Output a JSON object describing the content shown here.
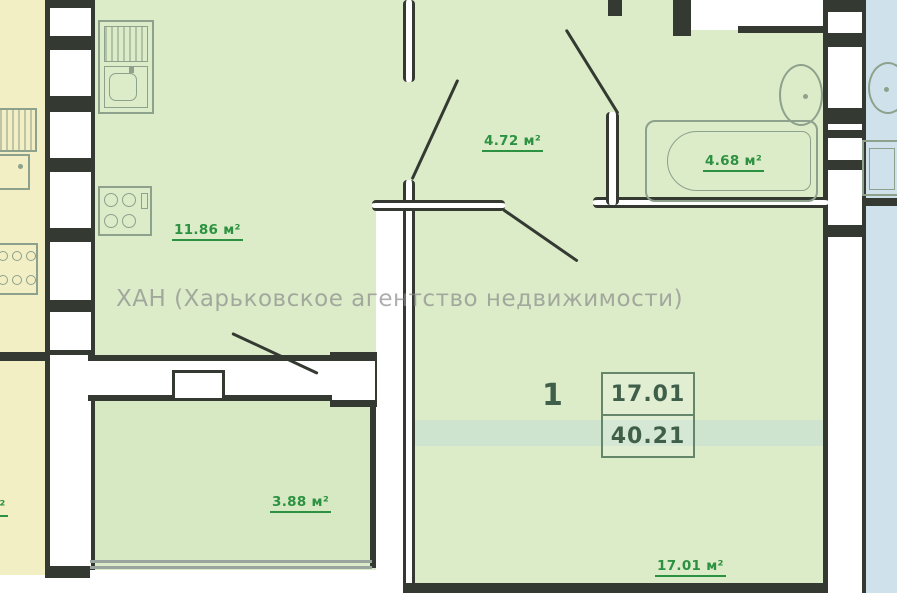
{
  "colors": {
    "apartment_fill": "#dcecc9",
    "balcony_fill": "#d6e9c2",
    "neighbor_left_fill": "#f3efc5",
    "neighbor_right_fill": "#cfe2ec",
    "wall_dark": "#343a31",
    "fixture_line": "#8da18c",
    "label_green": "#2c9140",
    "spec_green": "#3f5f4b",
    "window_line": "#9aa5a0"
  },
  "watermark": {
    "text": "ХАН (Харьковское агентство недвижимости)"
  },
  "rooms": {
    "kitchen": {
      "area": "11.86 м²"
    },
    "hallway": {
      "area": "4.72 м²"
    },
    "bathroom": {
      "area": "4.68 м²"
    },
    "balcony": {
      "area": "3.88 м²"
    },
    "living": {
      "area": "17.01 м²"
    }
  },
  "apartment_spec": {
    "rooms_count": "1",
    "living_area": "17.01",
    "total_area": "40.21"
  },
  "neighbor_left": {
    "partial_area": "м²"
  }
}
